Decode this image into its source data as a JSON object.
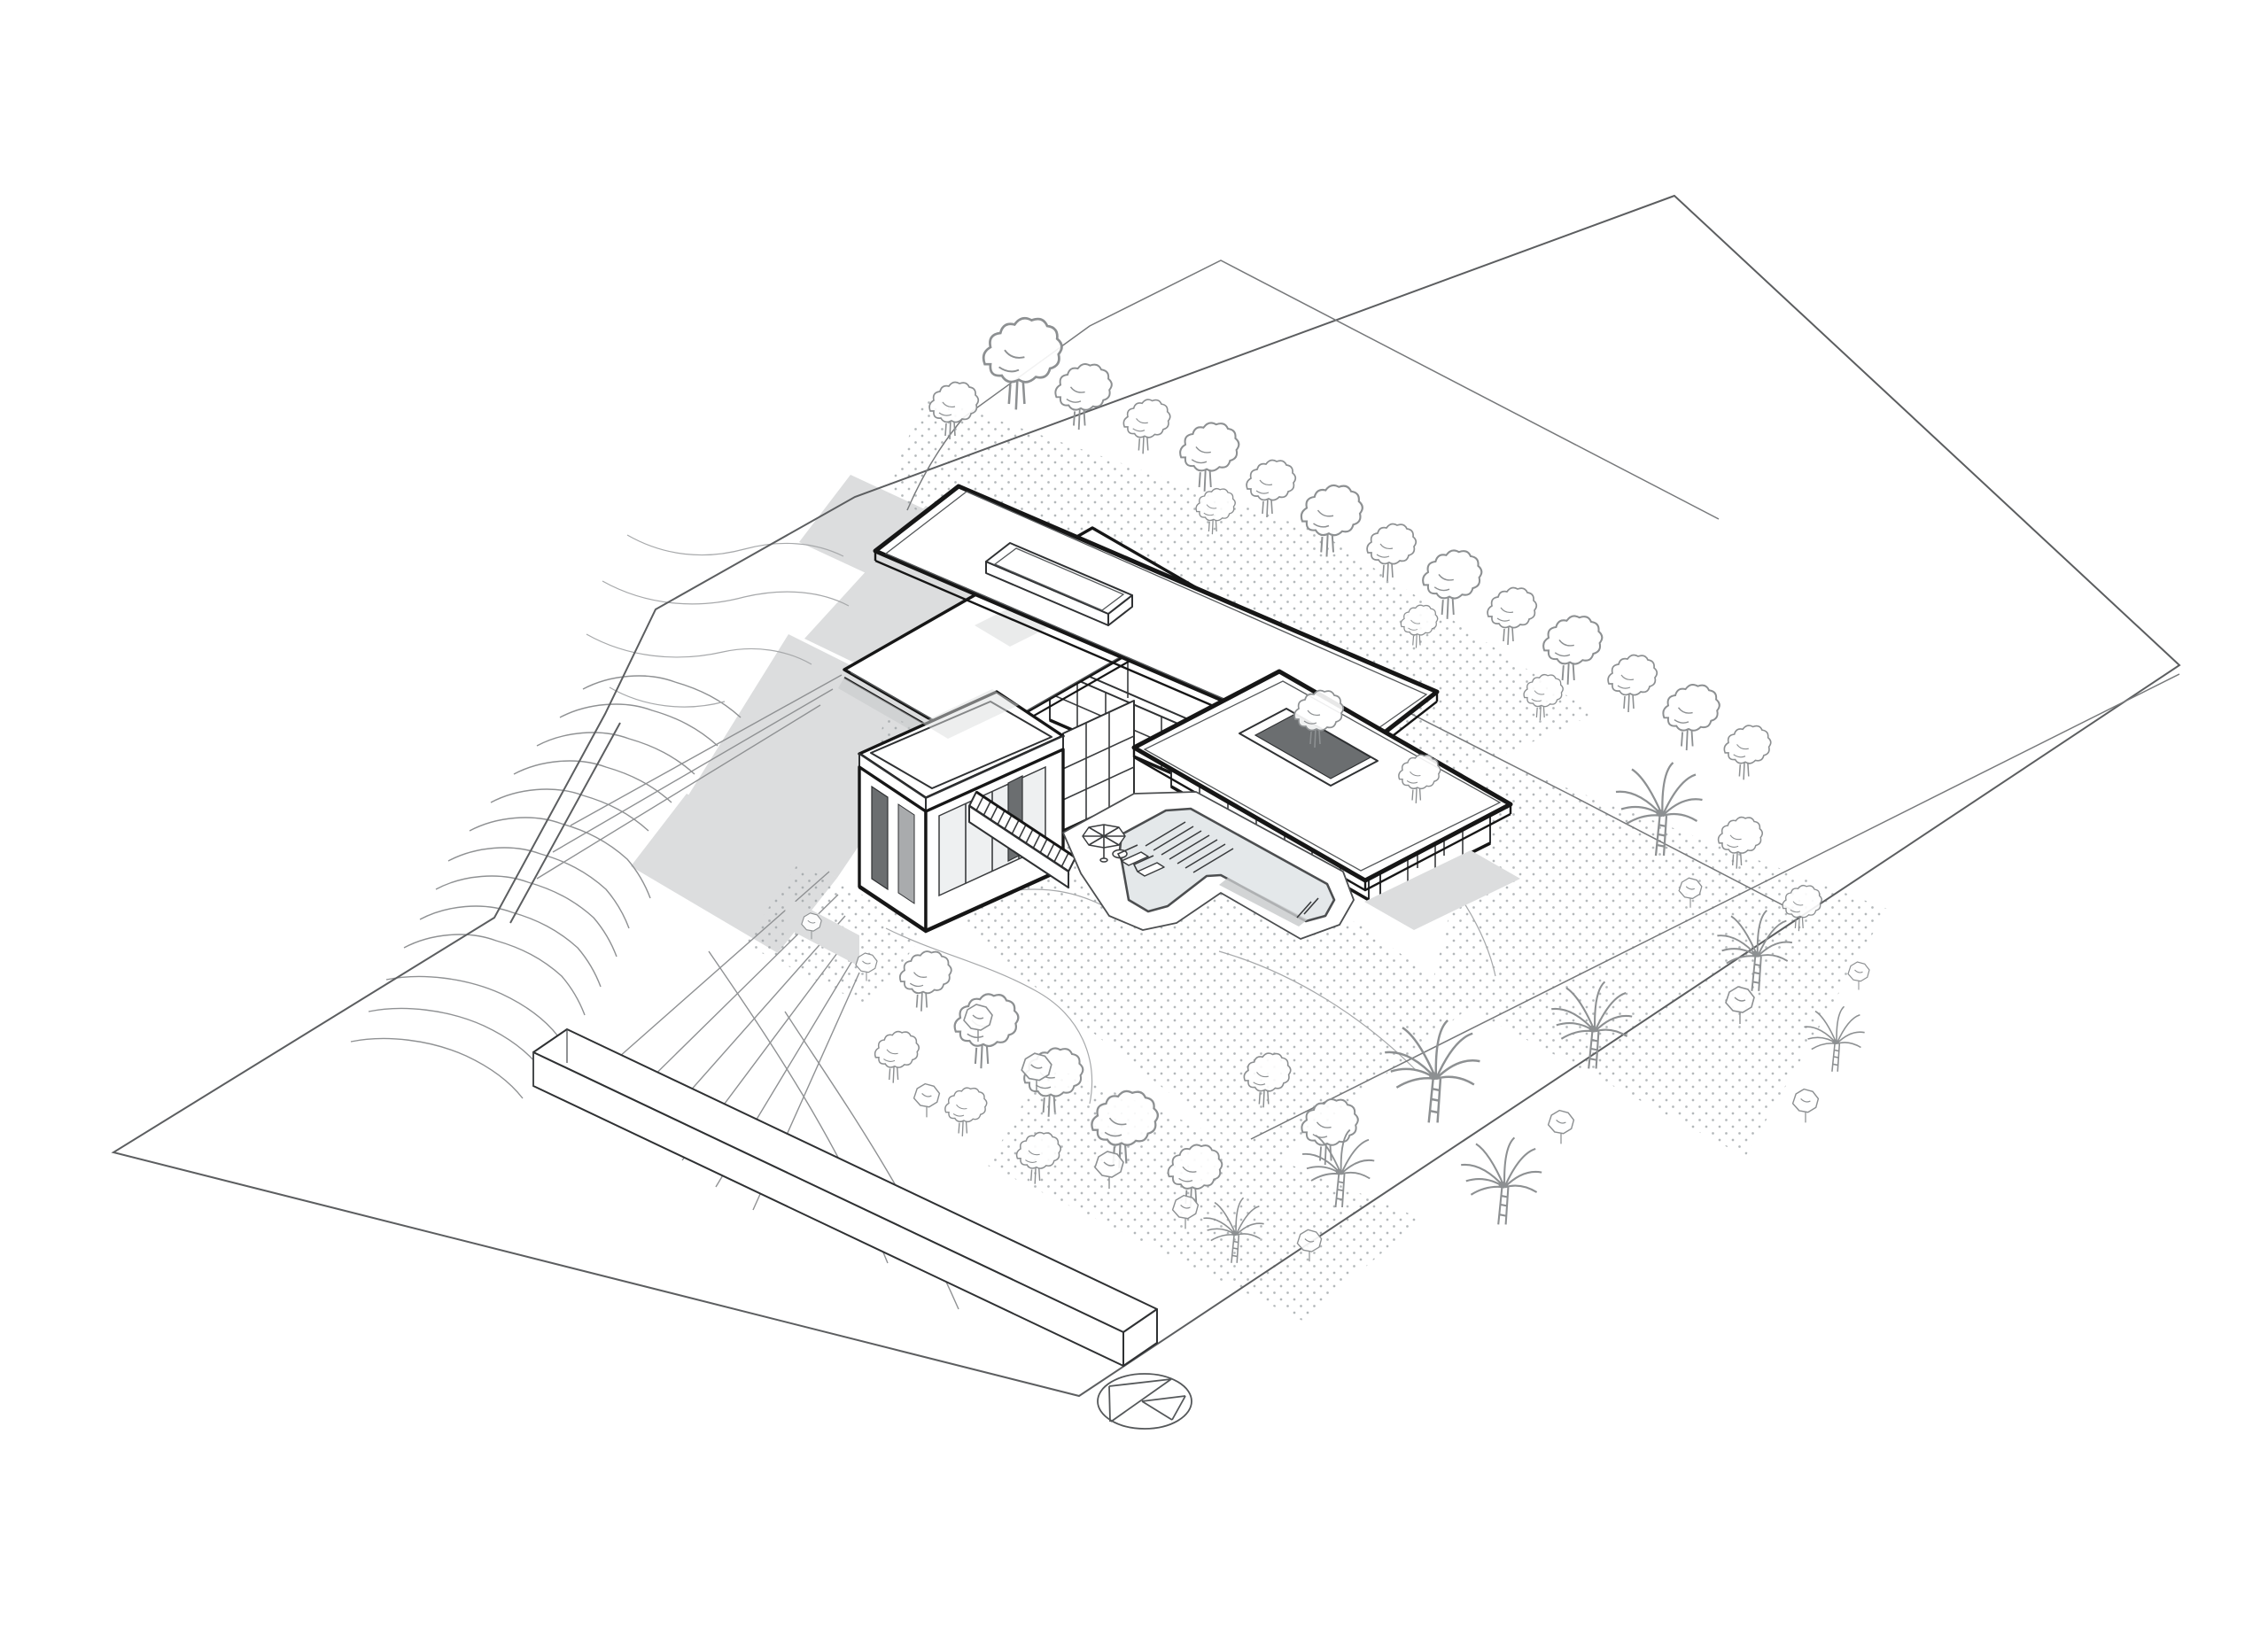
{
  "document": {
    "title": "Hillside residence — axonometric site plan",
    "description": "Black and white architectural axonometric site plan drawing of a modern flat-roofed hillside residence with an L-shaped swimming pool, terraced slope contours, garden vegetation, site boundary lines and a north arrow symbol",
    "drawing_type": "axonometric site plan",
    "background_color": "#ffffff"
  },
  "palette": {
    "paper": "#ffffff",
    "bold_line": "#161616",
    "medium_line": "#3a3c3e",
    "terrain_line": "#8f9193",
    "vegetation_line": "#8d9092",
    "boundary_line": "#5c5e60",
    "shadow_fill": "#dcddde",
    "opening_fill": "#6b6e70",
    "water_fill": "#e4e8ea",
    "stipple_dot": "#9aa0a3"
  },
  "legend": {
    "site_boundary": "Site boundary",
    "setback_line": "Setback line",
    "terraced_slope": "Terraced slope contours",
    "contour_lines": "Contour lines",
    "grading_lines": "Grading lines",
    "driveway": "Driveway edge",
    "ground_texture": "Stippled planting ground",
    "shadows": "Cast shadows",
    "retaining_wall": "Retaining wall along road",
    "trees": "Deciduous trees",
    "palms": "Palm trees",
    "shrubs": "Shrubs",
    "residence": "Residence",
    "upper_roof": "Upper wing flat roof",
    "skylight": "Roof skylight",
    "mid_roof": "Entry wing roof",
    "lower_roof": "Pool wing flat roof",
    "roof_opening": "Roof courtyard opening",
    "glazed_facade": "Glazed facade with mullions",
    "link_glazing": "Glazed link",
    "roof_terrace": "Roof terrace with parapet",
    "exterior_stair": "Exterior stair",
    "flue": "Roof flue",
    "pool": "Swimming pool",
    "pool_deck": "Pool deck",
    "pool_steps": "Pool steps",
    "umbrella": "Sun umbrella",
    "loungers": "Pool loungers",
    "north_arrow": "North arrow"
  }
}
